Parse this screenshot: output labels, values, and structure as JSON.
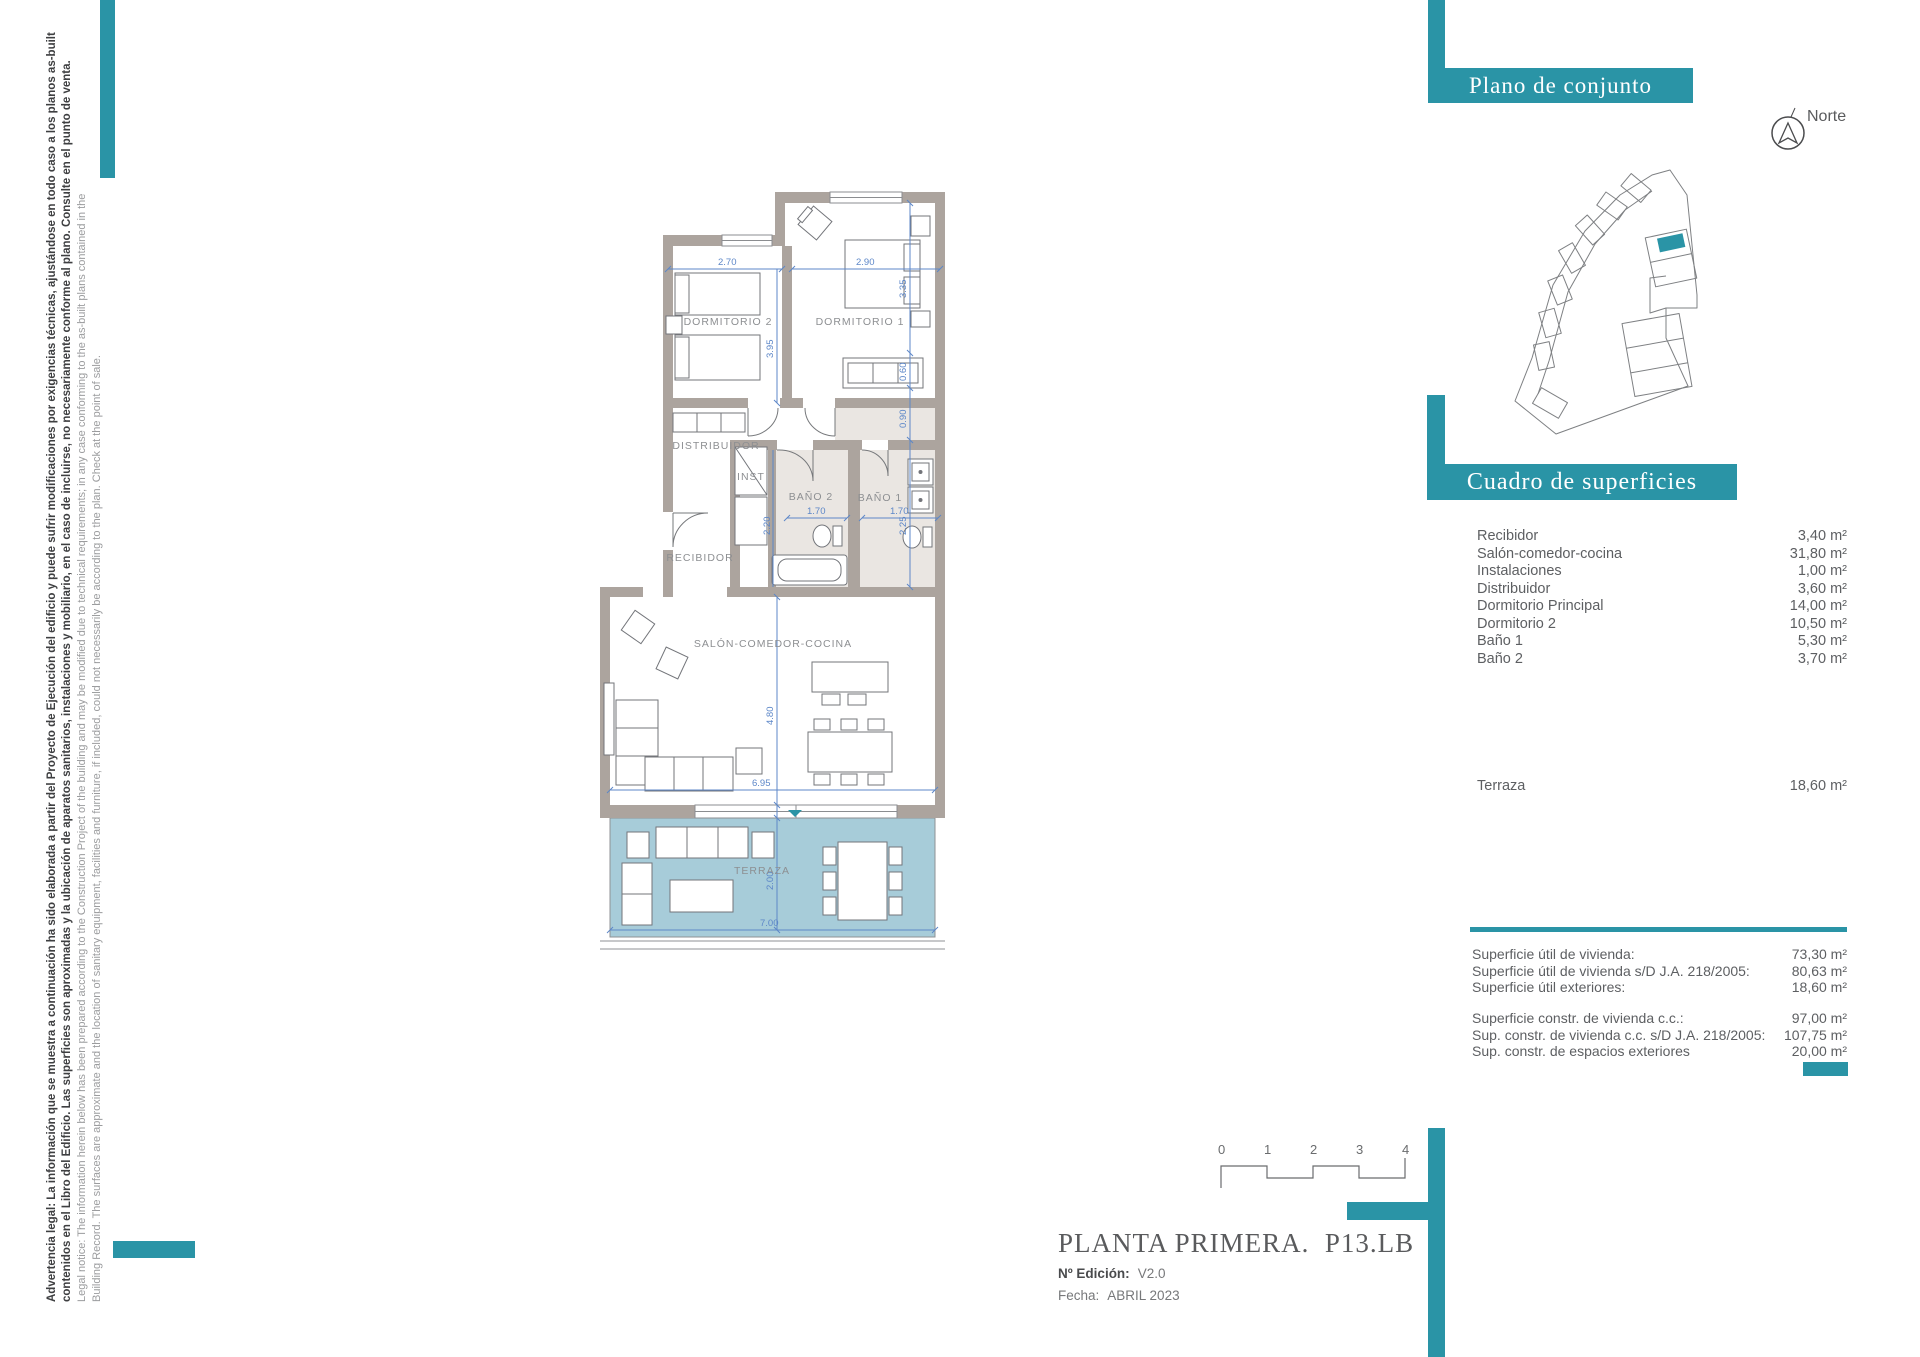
{
  "colors": {
    "accent": "#2a94a6",
    "terrace_fill": "#a7ccd9",
    "wall": "#aca49e",
    "dimension_blue": "#4d82c6"
  },
  "legal": {
    "line1": "Advertencia legal: La información que se muestra a continuación ha sido elaborada a partir del Proyecto de Ejecución del edificio y puede sufrir modificaciones por exigencias técnicas, ajustándose en todo caso a los planos as-built",
    "line2": "contenidos en el Libro del Edificio. Las superficies son aproximadas y la ubicación de aparatos sanitarios, instalaciones y mobiliario, en el caso de incluirse, no necesariamente conforme al plano. Consulte en el punto de venta.",
    "line3": "Legal notice: The information herein below has been prepared according to the Construction Project of the building and may be modified due to technical requirements; in any case conforming to the as-built plans contained in the",
    "line4": "Building Record. The surfaces are approximate and the location of sanitary equipment, facilities and furniture, if included, could not necessarily be according to the plan. Check at the point of sale."
  },
  "plano_conjunto": {
    "title": "Plano de conjunto",
    "north_label": "Norte"
  },
  "cuadro": {
    "title": "Cuadro de superficies",
    "rows": [
      {
        "label": "Recibidor",
        "value": "3,40 m²"
      },
      {
        "label": "Salón-comedor-cocina",
        "value": "31,80 m²"
      },
      {
        "label": "Instalaciones",
        "value": "1,00 m²"
      },
      {
        "label": "Distribuidor",
        "value": "3,60 m²"
      },
      {
        "label": "Dormitorio Principal",
        "value": "14,00 m²"
      },
      {
        "label": "Dormitorio 2",
        "value": "10,50 m²"
      },
      {
        "label": "Baño 1",
        "value": "5,30 m²"
      },
      {
        "label": "Baño 2",
        "value": "3,70 m²"
      }
    ],
    "terraza": {
      "label": "Terraza",
      "value": "18,60 m²"
    },
    "summary_util": [
      {
        "label": "Superficie útil de vivienda:",
        "value": "73,30 m²"
      },
      {
        "label": "Superficie útil de vivienda s/D J.A. 218/2005:",
        "value": "80,63 m²"
      },
      {
        "label": "Superficie útil exteriores:",
        "value": "18,60 m²"
      }
    ],
    "summary_constr": [
      {
        "label": "Superficie constr. de vivienda c.c.:",
        "value": "97,00 m²"
      },
      {
        "label": "Sup. constr. de vivienda c.c. s/D J.A. 218/2005:",
        "value": "107,75 m²"
      },
      {
        "label": "Sup. constr. de espacios exteriores",
        "value": "20,00 m²"
      }
    ]
  },
  "titleblock": {
    "title": "PLANTA PRIMERA.  P13.LB",
    "edition_label": "Nº Edición:",
    "edition_value": "V2.0",
    "date_label": "Fecha:",
    "date_value": "ABRIL 2023"
  },
  "scalebar": {
    "ticks": [
      "0",
      "1",
      "2",
      "3",
      "4"
    ]
  },
  "floorplan": {
    "rooms": {
      "dormitorio2": "DORMITORIO 2",
      "dormitorio1": "DORMITORIO 1",
      "distribuidor": "DISTRIBUIDOR",
      "inst": "INST",
      "bano2": "BAÑO 2",
      "bano1": "BAÑO 1",
      "recibidor": "RECIBIDOR",
      "salon": "SALÓN-COMEDOR-COCINA",
      "terraza": "TERRAZA"
    },
    "dims": {
      "d270": "2.70",
      "d290": "2.90",
      "d395": "3.95",
      "d335": "3.35",
      "d060": "0.60",
      "d090": "0.90",
      "d225": "2.25",
      "d220": "2.20",
      "d170a": "1.70",
      "d170b": "1.70",
      "d480": "4.80",
      "d695": "6.95",
      "d200": "2.00",
      "d700": "7.00"
    }
  }
}
